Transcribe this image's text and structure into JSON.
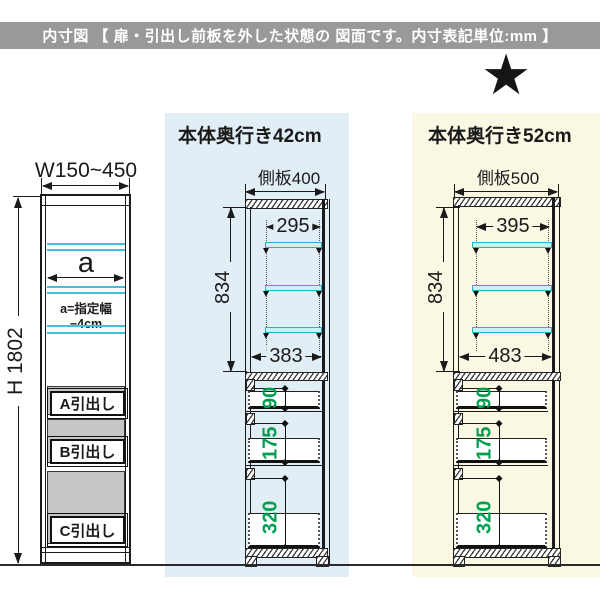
{
  "header": {
    "text": "内寸図 【 扉・引出し前板を外した状態の 図面です。内寸表記単位:mm 】"
  },
  "star_icon": "★",
  "colors": {
    "header_bar": "#999999",
    "panel_blue": "#e1eef6",
    "panel_yellow": "#faf7e3",
    "shelf_cyan": "#2aaecf",
    "dimension_green": "#009f50",
    "slot_gray": "#c6c6c6"
  },
  "left_unit": {
    "width_label": "W150~450",
    "height_label": "H 1802",
    "shelf_width_label": "a",
    "shelf_width_note": "a=指定幅−4cm",
    "drawers": [
      "A引出し",
      "B引出し",
      "C引出し"
    ]
  },
  "middle_unit": {
    "title": "本体奥行き42cm",
    "side_panel_label": "側板400",
    "shelf_depth": "295",
    "inner_height": "834",
    "inner_depth": "383",
    "drawer_dims": [
      "90",
      "175",
      "320"
    ]
  },
  "right_unit": {
    "title": "本体奥行き52cm",
    "side_panel_label": "側板500",
    "shelf_depth": "395",
    "inner_height": "834",
    "inner_depth": "483",
    "drawer_dims": [
      "90",
      "175",
      "320"
    ]
  }
}
